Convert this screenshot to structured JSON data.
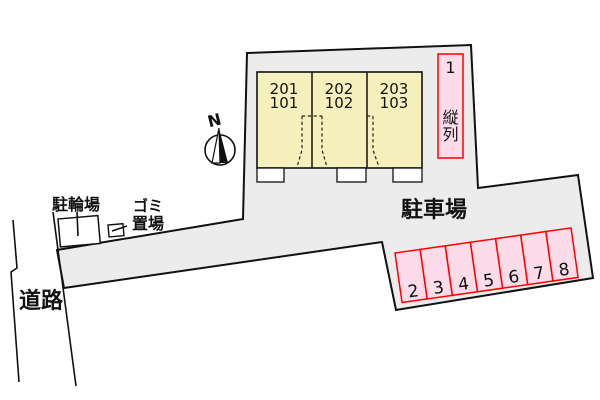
{
  "labels": {
    "bicycle_parking": "駐輪場",
    "garbage_line1": "ゴミ",
    "garbage_line2": "置場",
    "road": "道路",
    "parking_lot": "駐車場",
    "north": "N"
  },
  "building": {
    "units": [
      {
        "upper": "201",
        "lower": "101"
      },
      {
        "upper": "202",
        "lower": "102"
      },
      {
        "upper": "203",
        "lower": "103"
      }
    ]
  },
  "parking": {
    "tandem": {
      "number": "1",
      "chars": [
        "縦",
        "列"
      ]
    },
    "spaces": [
      "2",
      "3",
      "4",
      "5",
      "6",
      "7",
      "8"
    ]
  },
  "colors": {
    "lot_gray": "#ececec",
    "building_yellow": "#f6f0bd",
    "space_pink": "#fcdce9",
    "space_red": "#ff0000",
    "line_black": "#111111"
  }
}
